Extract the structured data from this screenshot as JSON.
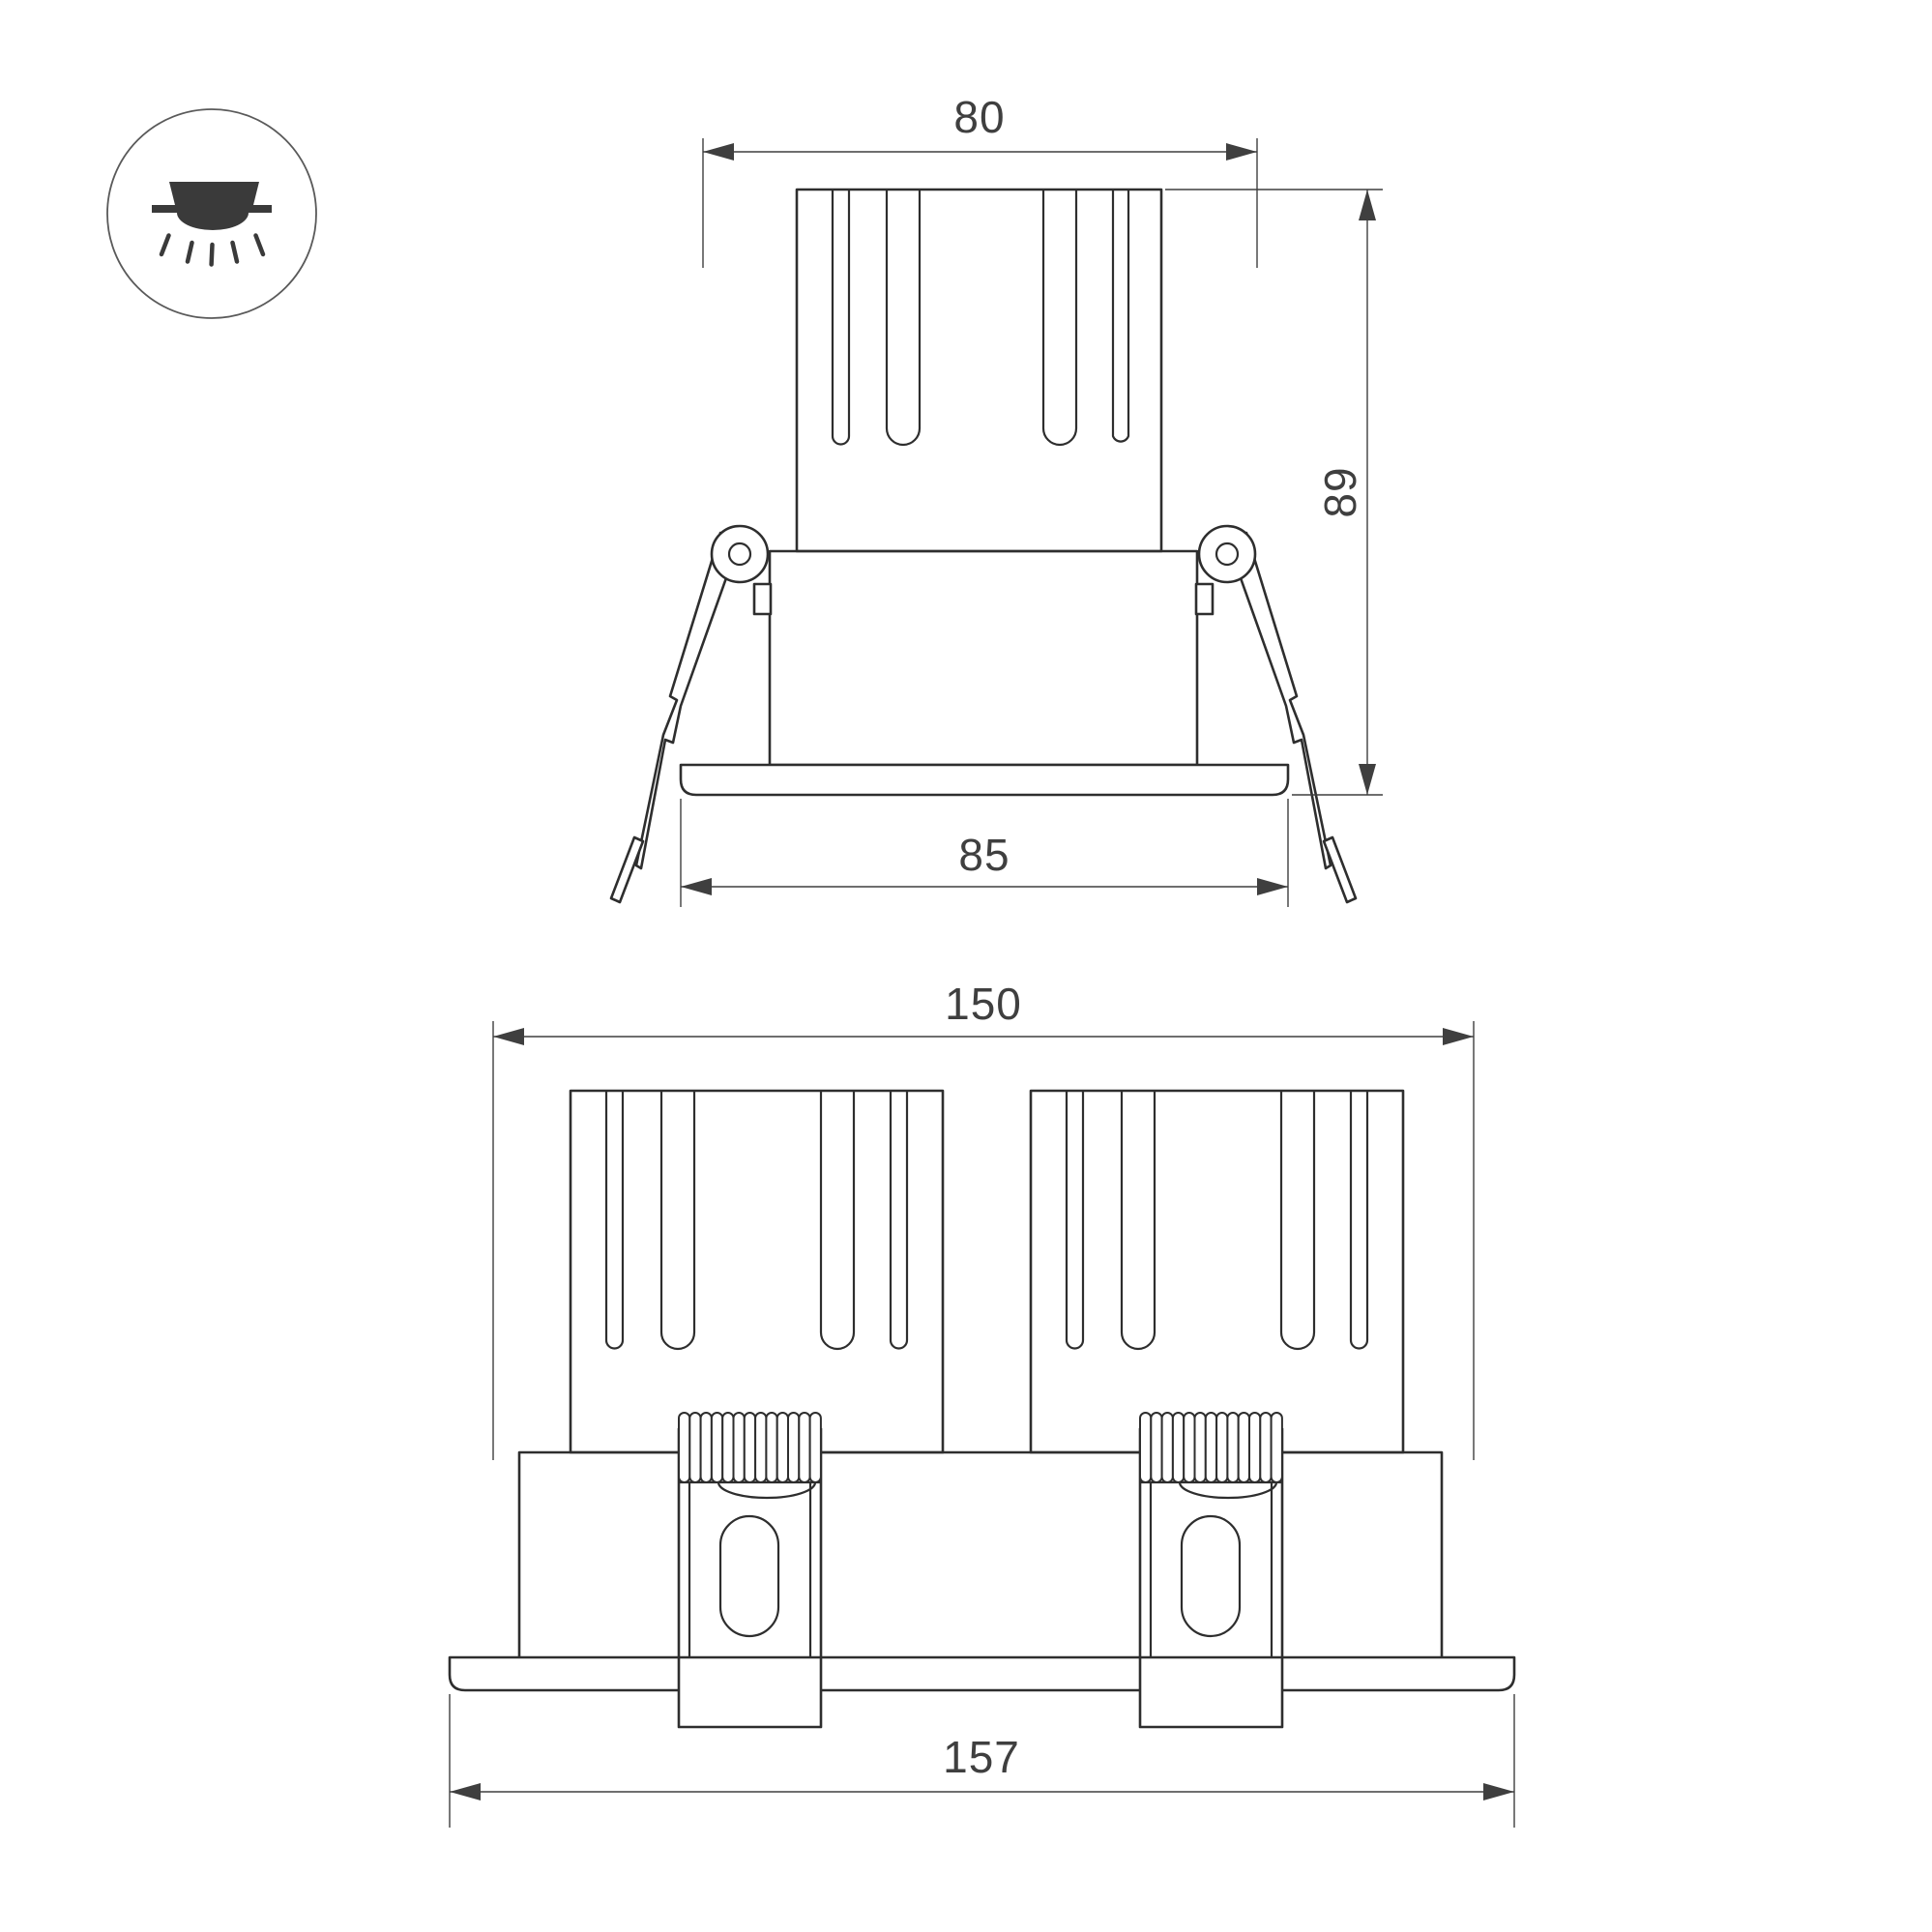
{
  "icon": {
    "name": "recessed-downlight-icon"
  },
  "single_view": {
    "dim_top": "80",
    "dim_height": "89",
    "dim_bottom": "85"
  },
  "double_view": {
    "dim_top": "150",
    "dim_bottom": "157"
  },
  "colors": {
    "background": "#ffffff",
    "outline": "#2e2e2e",
    "dimension_line": "#3f3f3f",
    "dimension_text": "#3f3f3f",
    "icon_fill": "#3a3a3a"
  }
}
